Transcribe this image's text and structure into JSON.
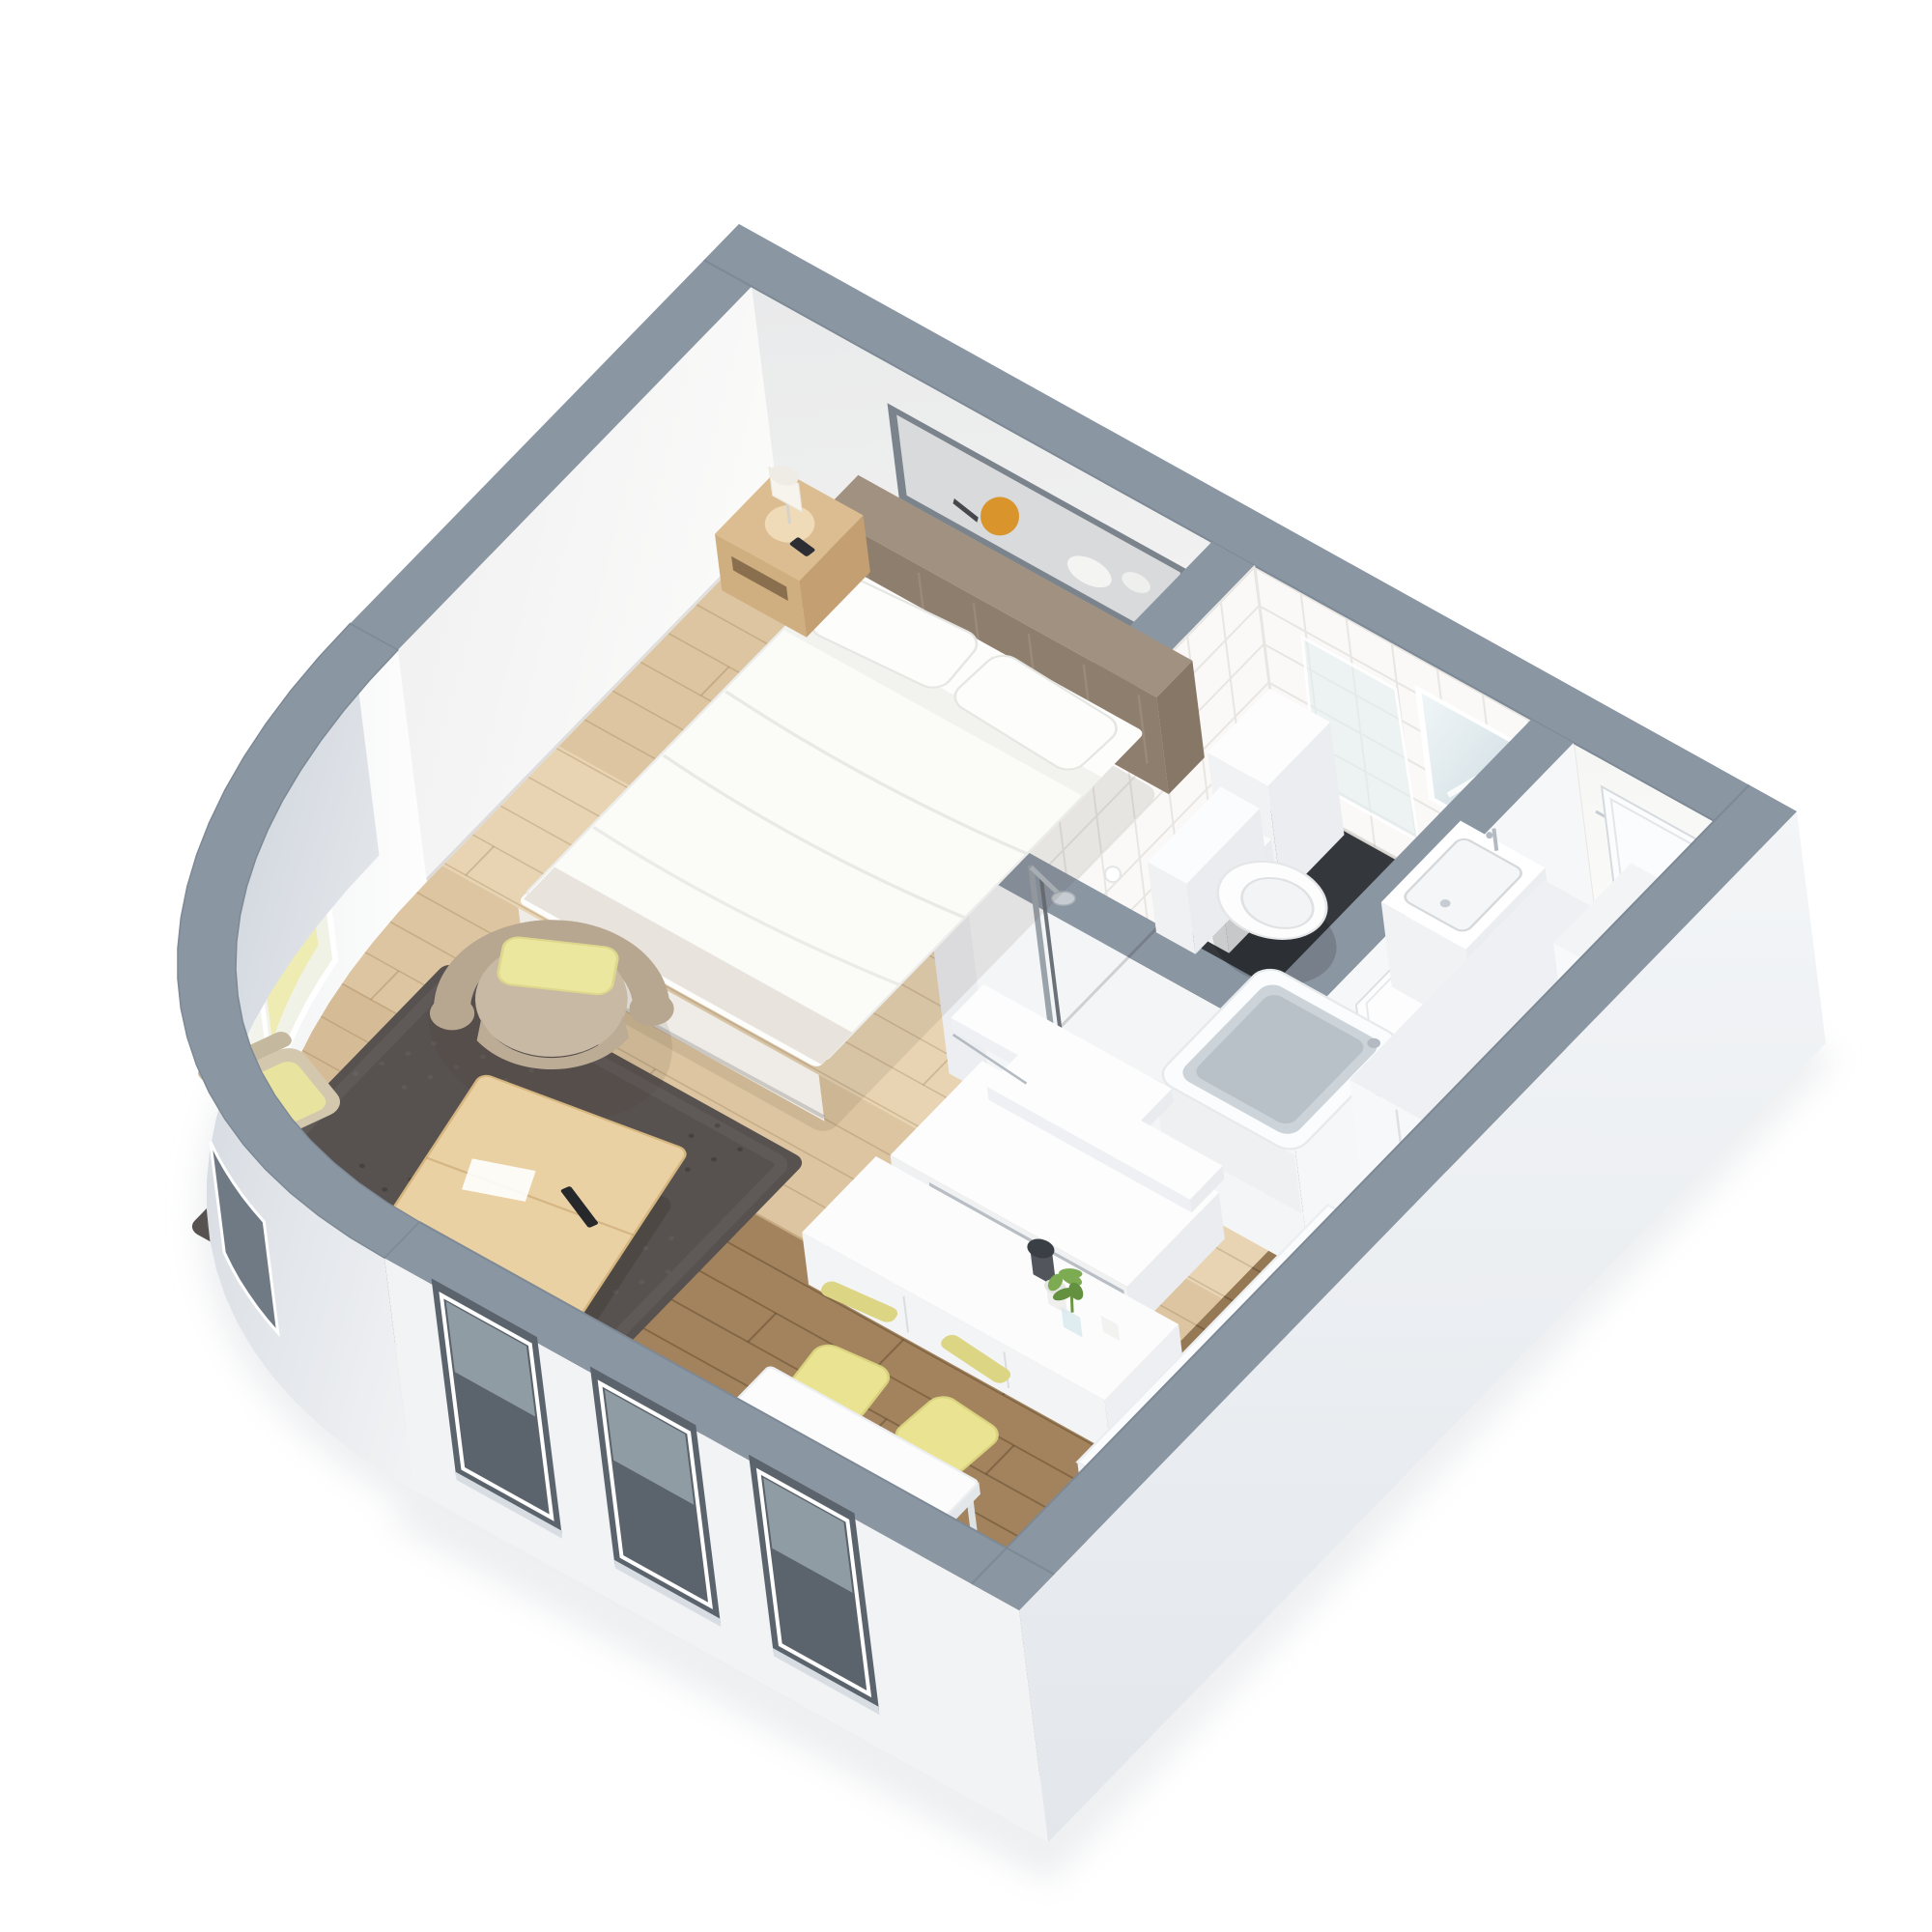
{
  "scene": {
    "title": "3D cutaway floor plan of a studio apartment",
    "view": "axonometric top-down",
    "background": "#ffffff"
  },
  "palette": {
    "wall_top": "#8b96a3",
    "wall_top_edge": "#7d8995",
    "wall_inner": "#f4f4f2",
    "wall_inner_shade": "#e9eaec",
    "wall_outer": "#f1f3f5",
    "wall_outer_shadow": "#c9d0d9",
    "floor_light": "#dcc5a0",
    "floor_light_grain": "#a97f54",
    "floor_dark": "#a2835d",
    "floor_dark_grain": "#5e452c",
    "bath_floor": "#3b4046",
    "tile": "#faf9f7",
    "tile_line": "#e8e6e2",
    "rug": "#57514f",
    "headboard": "#a19180",
    "linen": "#fdfdfc",
    "wood_light": "#ead1a4",
    "wood_nightstand": "#dcbd92",
    "accent_yellow": "#eae492",
    "accent_yellow_dark": "#d9d27f",
    "armchair": "#b7a690",
    "armchair_seat": "#c8b9a4",
    "chrome": "#b3bac1",
    "mirror_blue": "#ccdae0",
    "window_recess": "#5b636c",
    "glass_sky": "#aebbc3",
    "photo_amber": "#d9952c",
    "plant_green": "#7cab52",
    "magazine_sea": "#3e86b5",
    "magazine_sand": "#d9c89b"
  },
  "magazine": {
    "text": "TRAVEL"
  },
  "rooms": [
    {
      "id": "bedroom",
      "label": "sleeping area"
    },
    {
      "id": "living-area",
      "label": "lounge area"
    },
    {
      "id": "bathroom",
      "label": "bathroom"
    },
    {
      "id": "entry-hall",
      "label": "entry hall"
    },
    {
      "id": "kitchen-dining",
      "label": "kitchen and dining"
    }
  ],
  "items": [
    {
      "id": "ground-shadow",
      "label": "soft ground shadow"
    },
    {
      "id": "wall-ne-face",
      "label": "north-east wall interior"
    },
    {
      "id": "wall-art",
      "label": "framed artwork above bed"
    },
    {
      "id": "bathroom-mirror",
      "label": "bathroom mirror"
    },
    {
      "id": "entry-door",
      "label": "apartment entry door"
    },
    {
      "id": "wall-nw-face",
      "label": "north-west wall interior"
    },
    {
      "id": "curved-window",
      "label": "window in curved wall"
    },
    {
      "id": "wall-tops-back",
      "label": "rear wall tops"
    },
    {
      "id": "floor-light",
      "label": "light oak floor"
    },
    {
      "id": "floor-dark",
      "label": "dark oak floor"
    },
    {
      "id": "bathroom-floor",
      "label": "bathroom dark floor"
    },
    {
      "id": "area-rug",
      "label": "dark area rug"
    },
    {
      "id": "bathroom-walls",
      "label": "bathroom partition walls"
    },
    {
      "id": "bathroom-door",
      "label": "bathroom door"
    },
    {
      "id": "bath-shelf",
      "label": "bathroom shelf unit"
    },
    {
      "id": "toilet",
      "label": "toilet"
    },
    {
      "id": "bathroom-sink",
      "label": "wash basin"
    },
    {
      "id": "bathtub",
      "label": "bathtub"
    },
    {
      "id": "shower",
      "label": "shower fitting"
    },
    {
      "id": "central-unit",
      "label": "wall unit with shelves and desk"
    },
    {
      "id": "sideboard",
      "label": "white sideboard with decor"
    },
    {
      "id": "bed",
      "label": "double bed"
    },
    {
      "id": "nightstand",
      "label": "nightstand with table lamp"
    },
    {
      "id": "armchair",
      "label": "armchair with accent pillow"
    },
    {
      "id": "side-chair",
      "label": "side chair"
    },
    {
      "id": "coffee-table",
      "label": "wooden coffee table"
    },
    {
      "id": "dining-chairs-back",
      "label": "dining chairs (rear pair)"
    },
    {
      "id": "dining-table",
      "label": "dining table"
    },
    {
      "id": "magazine",
      "label": "travel magazine"
    },
    {
      "id": "smartphone",
      "label": "smartphone"
    },
    {
      "id": "dining-chairs-front",
      "label": "dining chairs (front pair)"
    },
    {
      "id": "wardrobe",
      "label": "tall wardrobe"
    },
    {
      "id": "kitchen-cabinet",
      "label": "kitchen cabinet"
    },
    {
      "id": "kitchen-counter",
      "label": "kitchen counter with sink"
    },
    {
      "id": "front-walls",
      "label": "front outer walls"
    },
    {
      "id": "windows-sw",
      "label": "three facade windows"
    },
    {
      "id": "curved-wall-outer",
      "label": "curved outer wall"
    }
  ]
}
